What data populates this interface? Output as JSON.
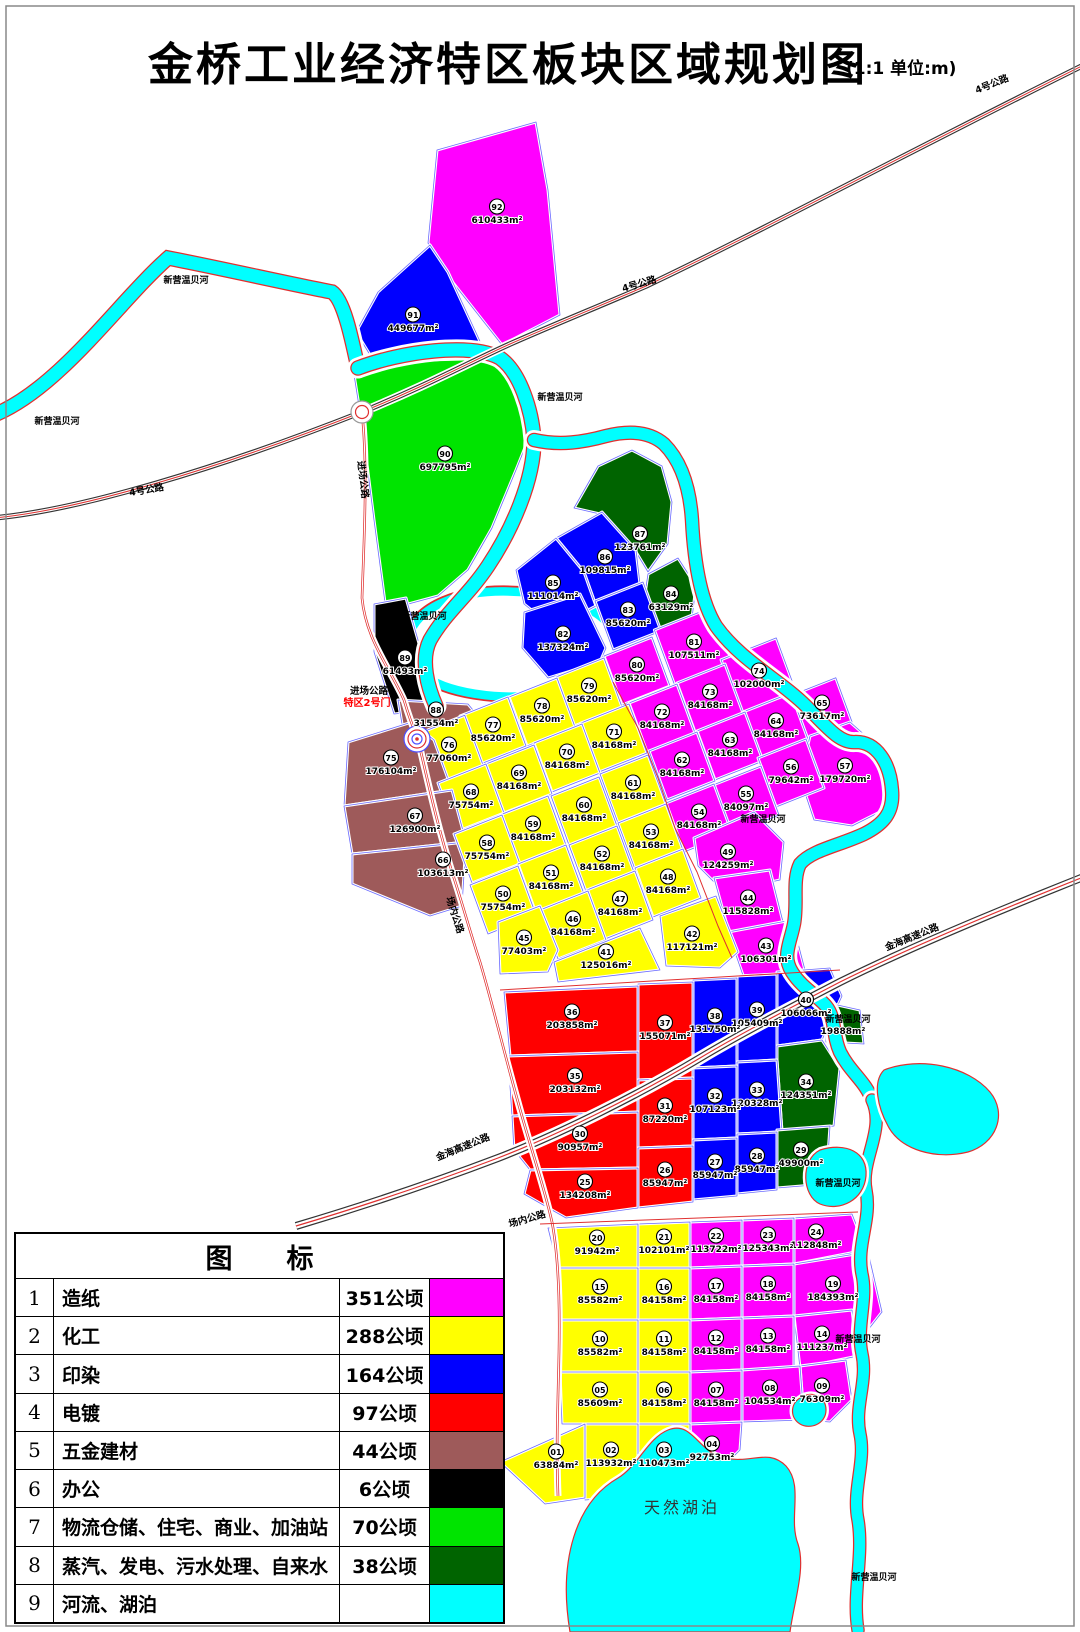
{
  "title": "金桥工业经济特区板块区域规划图",
  "scale_note": "(1:1  单位:m)",
  "area_unit": "m²",
  "legend": {
    "title": "图　　标",
    "rows": [
      {
        "num": "1",
        "name": "造纸",
        "area": "351公顷",
        "color": "#FF00FF"
      },
      {
        "num": "2",
        "name": "化工",
        "area": "288公顷",
        "color": "#FFFF00"
      },
      {
        "num": "3",
        "name": "印染",
        "area": "164公顷",
        "color": "#0000FF"
      },
      {
        "num": "4",
        "name": "电镀",
        "area": "97公顷",
        "color": "#FF0000"
      },
      {
        "num": "5",
        "name": "五金建材",
        "area": "44公顷",
        "color": "#9E5A5A"
      },
      {
        "num": "6",
        "name": "办公",
        "area": "6公顷",
        "color": "#000000"
      },
      {
        "num": "7",
        "name": "物流仓储、住宅、商业、加油站",
        "area": "70公顷",
        "color": "#00E400"
      },
      {
        "num": "8",
        "name": "蒸汽、发电、污水处理、自来水",
        "area": "38公顷",
        "color": "#006400"
      },
      {
        "num": "9",
        "name": "河流、湖泊",
        "area": "",
        "color": "#00FFFF"
      }
    ]
  },
  "map_labels": [
    {
      "kind": "river",
      "text": "新营温贝河",
      "x": 57,
      "y": 424,
      "rot": 0
    },
    {
      "kind": "river",
      "text": "新营温贝河",
      "x": 186,
      "y": 283,
      "rot": 0
    },
    {
      "kind": "river",
      "text": "新营温贝河",
      "x": 560,
      "y": 400,
      "rot": 0
    },
    {
      "kind": "river",
      "text": "新营温贝河",
      "x": 424,
      "y": 619,
      "rot": 0
    },
    {
      "kind": "river",
      "text": "新营温贝河",
      "x": 763,
      "y": 822,
      "rot": 0
    },
    {
      "kind": "river",
      "text": "新营温贝河",
      "x": 848,
      "y": 1022,
      "rot": 0
    },
    {
      "kind": "river",
      "text": "新营温贝河",
      "x": 838,
      "y": 1186,
      "rot": 0
    },
    {
      "kind": "river",
      "text": "新营温贝河",
      "x": 858,
      "y": 1342,
      "rot": 0
    },
    {
      "kind": "river",
      "text": "新营温贝河",
      "x": 874,
      "y": 1580,
      "rot": 0
    },
    {
      "kind": "road",
      "text": "4号公路",
      "x": 993,
      "y": 87,
      "rot": -22
    },
    {
      "kind": "road",
      "text": "4号公路",
      "x": 640,
      "y": 287,
      "rot": -16
    },
    {
      "kind": "road",
      "text": "4号公路",
      "x": 147,
      "y": 493,
      "rot": -10
    },
    {
      "kind": "road",
      "text": "进场公路",
      "x": 360,
      "y": 480,
      "rot": 83
    },
    {
      "kind": "road",
      "text": "进场公路",
      "x": 369,
      "y": 694,
      "rot": 0
    },
    {
      "kind": "gate",
      "text": "特区2号门",
      "x": 367,
      "y": 706,
      "rot": 0
    },
    {
      "kind": "road",
      "text": "场内公路",
      "x": 452,
      "y": 916,
      "rot": 72
    },
    {
      "kind": "road",
      "text": "场内公路",
      "x": 528,
      "y": 1222,
      "rot": -16
    },
    {
      "kind": "road",
      "text": "金海高速公路",
      "x": 913,
      "y": 940,
      "rot": -22
    },
    {
      "kind": "road",
      "text": "金海高速公路",
      "x": 464,
      "y": 1150,
      "rot": -22
    },
    {
      "kind": "lake",
      "text": "天然湖泊",
      "x": 682,
      "y": 1513,
      "rot": 0
    }
  ],
  "blocks": [
    {
      "id": "92",
      "area": 610433,
      "cat": "1"
    },
    {
      "id": "91",
      "area": 449677,
      "cat": "3"
    },
    {
      "id": "90",
      "area": 697795,
      "cat": "7"
    },
    {
      "id": "89",
      "area": 61493,
      "cat": "6"
    },
    {
      "id": "88",
      "area": 31554,
      "cat": "5"
    },
    {
      "id": "87",
      "area": 123761,
      "cat": "8"
    },
    {
      "id": "86",
      "area": 109815,
      "cat": "3"
    },
    {
      "id": "85",
      "area": 111014,
      "cat": "3"
    },
    {
      "id": "84",
      "area": 63129,
      "cat": "8"
    },
    {
      "id": "83",
      "area": 85620,
      "cat": "3"
    },
    {
      "id": "82",
      "area": 137324,
      "cat": "3"
    },
    {
      "id": "81",
      "area": 107511,
      "cat": "1"
    },
    {
      "id": "80",
      "area": 85620,
      "cat": "1"
    },
    {
      "id": "79",
      "area": 85620,
      "cat": "2"
    },
    {
      "id": "78",
      "area": 85620,
      "cat": "2"
    },
    {
      "id": "77",
      "area": 85620,
      "cat": "2"
    },
    {
      "id": "76",
      "area": 77060,
      "cat": "2"
    },
    {
      "id": "75",
      "area": 176104,
      "cat": "5"
    },
    {
      "id": "74",
      "area": 102000,
      "cat": "1"
    },
    {
      "id": "73",
      "area": 84168,
      "cat": "1"
    },
    {
      "id": "72",
      "area": 84168,
      "cat": "1"
    },
    {
      "id": "71",
      "area": 84168,
      "cat": "2"
    },
    {
      "id": "70",
      "area": 84168,
      "cat": "2"
    },
    {
      "id": "69",
      "area": 84168,
      "cat": "2"
    },
    {
      "id": "68",
      "area": 75754,
      "cat": "2"
    },
    {
      "id": "67",
      "area": 126900,
      "cat": "5"
    },
    {
      "id": "66",
      "area": 103613,
      "cat": "5"
    },
    {
      "id": "65",
      "area": 73617,
      "cat": "1"
    },
    {
      "id": "64",
      "area": 84168,
      "cat": "1"
    },
    {
      "id": "63",
      "area": 84168,
      "cat": "1"
    },
    {
      "id": "62",
      "area": 84168,
      "cat": "1"
    },
    {
      "id": "61",
      "area": 84168,
      "cat": "2"
    },
    {
      "id": "60",
      "area": 84168,
      "cat": "2"
    },
    {
      "id": "59",
      "area": 84168,
      "cat": "2"
    },
    {
      "id": "58",
      "area": 75754,
      "cat": "2"
    },
    {
      "id": "57",
      "area": 179720,
      "cat": "1"
    },
    {
      "id": "56",
      "area": 79642,
      "cat": "1"
    },
    {
      "id": "55",
      "area": 84097,
      "cat": "1"
    },
    {
      "id": "54",
      "area": 84168,
      "cat": "1"
    },
    {
      "id": "53",
      "area": 84168,
      "cat": "2"
    },
    {
      "id": "52",
      "area": 84168,
      "cat": "2"
    },
    {
      "id": "51",
      "area": 84168,
      "cat": "2"
    },
    {
      "id": "50",
      "area": 75754,
      "cat": "2"
    },
    {
      "id": "49",
      "area": 124259,
      "cat": "1"
    },
    {
      "id": "48",
      "area": 84168,
      "cat": "2"
    },
    {
      "id": "47",
      "area": 84168,
      "cat": "2"
    },
    {
      "id": "46",
      "area": 84168,
      "cat": "2"
    },
    {
      "id": "45",
      "area": 77403,
      "cat": "2"
    },
    {
      "id": "44",
      "area": 115828,
      "cat": "1"
    },
    {
      "id": "43",
      "area": 106301,
      "cat": "1"
    },
    {
      "id": "42",
      "area": 117121,
      "cat": "2"
    },
    {
      "id": "41",
      "area": 125016,
      "cat": "2"
    },
    {
      "id": "40",
      "area": 106066,
      "cat": "3"
    },
    {
      "id": "39",
      "area": 105409,
      "cat": "3"
    },
    {
      "id": "38",
      "area": 131750,
      "cat": "3"
    },
    {
      "id": "37",
      "area": 155071,
      "cat": "4"
    },
    {
      "id": "36",
      "area": 203858,
      "cat": "4"
    },
    {
      "id": "35",
      "area": 203132,
      "cat": "4"
    },
    {
      "id": "34",
      "area": 124351,
      "cat": "8"
    },
    {
      "id": "33",
      "area": 120328,
      "cat": "3"
    },
    {
      "id": "32",
      "area": 107123,
      "cat": "3"
    },
    {
      "id": "31",
      "area": 87220,
      "cat": "4"
    },
    {
      "id": "30",
      "area": 90957,
      "cat": "4"
    },
    {
      "id": "29",
      "area": 49900,
      "cat": "8"
    },
    {
      "id": "28",
      "area": 85947,
      "cat": "3"
    },
    {
      "id": "27",
      "area": 85947,
      "cat": "3"
    },
    {
      "id": "26",
      "area": 85947,
      "cat": "4"
    },
    {
      "id": "25",
      "area": 134208,
      "cat": "4"
    },
    {
      "id": "",
      "area": 19888,
      "cat": "8"
    },
    {
      "id": "24",
      "area": 112848,
      "cat": "1"
    },
    {
      "id": "23",
      "area": 125343,
      "cat": "1"
    },
    {
      "id": "22",
      "area": 113722,
      "cat": "1"
    },
    {
      "id": "21",
      "area": 102101,
      "cat": "2"
    },
    {
      "id": "20",
      "area": 91942,
      "cat": "2"
    },
    {
      "id": "19",
      "area": 184393,
      "cat": "1"
    },
    {
      "id": "18",
      "area": 84158,
      "cat": "1"
    },
    {
      "id": "17",
      "area": 84158,
      "cat": "1"
    },
    {
      "id": "16",
      "area": 84158,
      "cat": "2"
    },
    {
      "id": "15",
      "area": 85582,
      "cat": "2"
    },
    {
      "id": "14",
      "area": 111237,
      "cat": "1"
    },
    {
      "id": "13",
      "area": 84158,
      "cat": "1"
    },
    {
      "id": "12",
      "area": 84158,
      "cat": "1"
    },
    {
      "id": "11",
      "area": 84158,
      "cat": "2"
    },
    {
      "id": "10",
      "area": 85582,
      "cat": "2"
    },
    {
      "id": "09",
      "area": 76309,
      "cat": "1"
    },
    {
      "id": "08",
      "area": 104534,
      "cat": "1"
    },
    {
      "id": "07",
      "area": 84158,
      "cat": "1"
    },
    {
      "id": "06",
      "area": 84158,
      "cat": "2"
    },
    {
      "id": "05",
      "area": 85609,
      "cat": "2"
    },
    {
      "id": "04",
      "area": 92753,
      "cat": "1"
    },
    {
      "id": "03",
      "area": 110473,
      "cat": "2"
    },
    {
      "id": "02",
      "area": 113932,
      "cat": "2"
    },
    {
      "id": "01",
      "area": 63884,
      "cat": "2"
    }
  ]
}
